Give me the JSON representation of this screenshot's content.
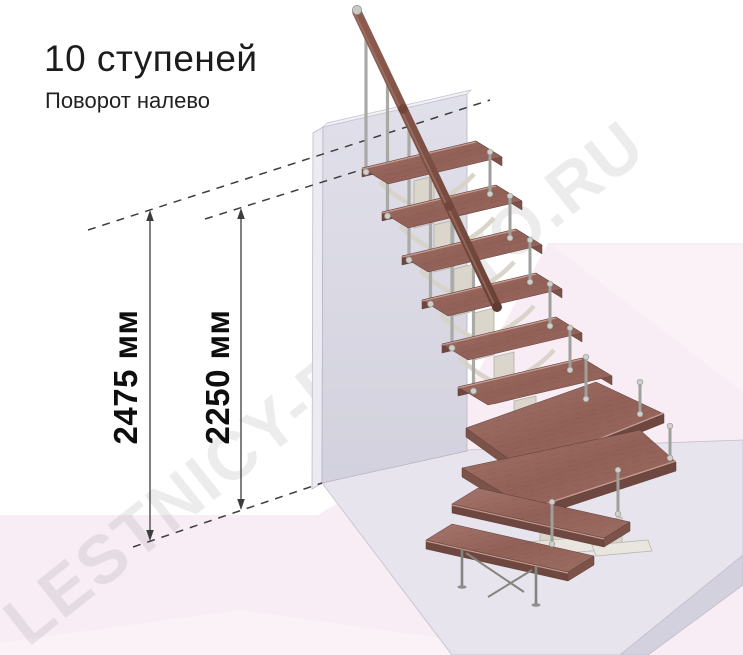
{
  "header": {
    "title": "10 ступеней",
    "subtitle": "Поворот налево"
  },
  "dimensions": [
    {
      "name": "total-height",
      "label": "2475 мм"
    },
    {
      "name": "flight-height",
      "label": "2250 мм"
    }
  ],
  "watermark": {
    "text": "LESTNICY-PROSTO.RU"
  },
  "colors": {
    "floor_pink": "#f8edf5",
    "floor_pink_light": "#fbf2f8",
    "platform": "#e7e4ee",
    "wall": "#d9d8e2",
    "wood": "#99685f",
    "watermark_gray": "#1a1a1a",
    "dimension": "#0e0e0e"
  }
}
